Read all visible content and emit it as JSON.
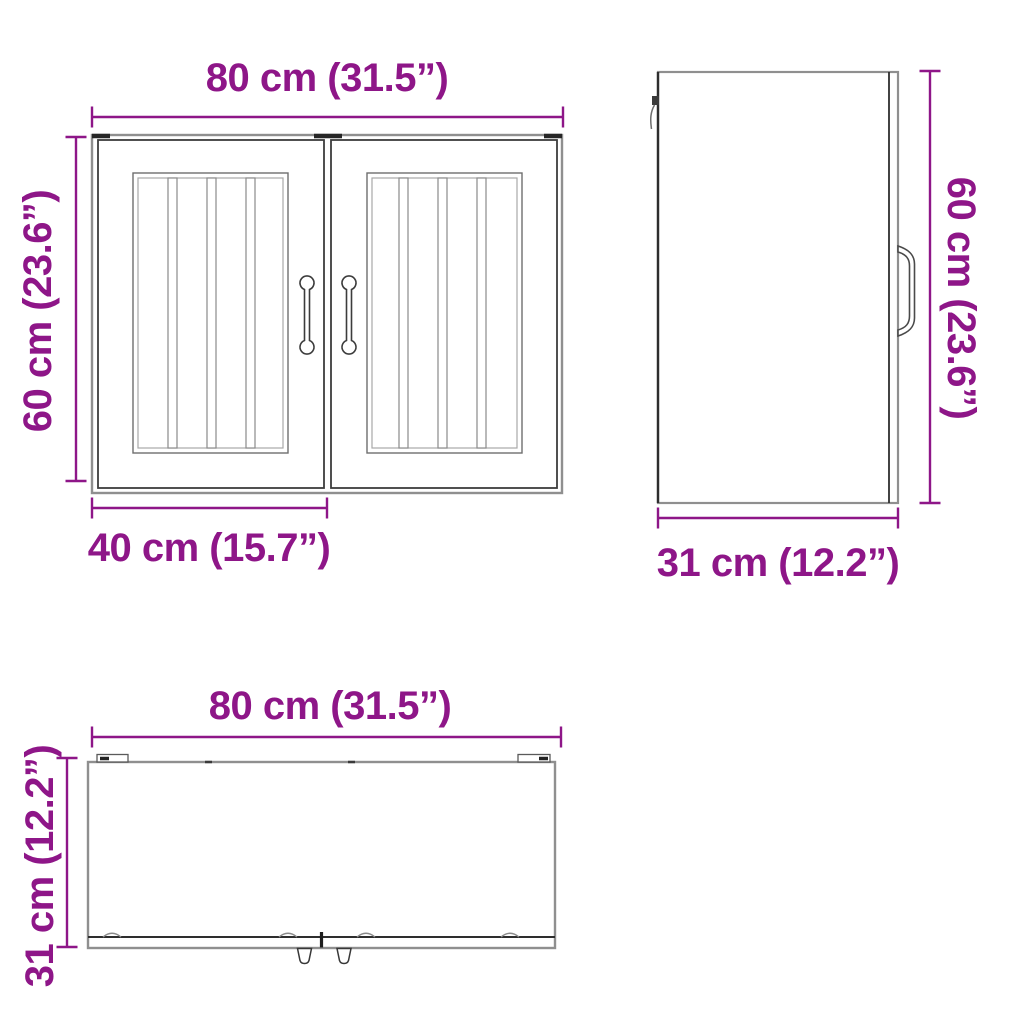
{
  "colors": {
    "accent": "#8E1688",
    "outline_dark": "#3c3c3c",
    "outline_light": "#8f8f8f"
  },
  "views": {
    "front": {
      "width_label": "80 cm (31.5”)",
      "height_label": "60 cm (23.6”)",
      "door_width_label": "40 cm (15.7”)"
    },
    "side": {
      "height_label": "60 cm (23.6”)",
      "depth_label": "31 cm (12.2”)"
    },
    "top": {
      "width_label": "80 cm (31.5”)",
      "depth_label": "31 cm (12.2”)"
    }
  }
}
